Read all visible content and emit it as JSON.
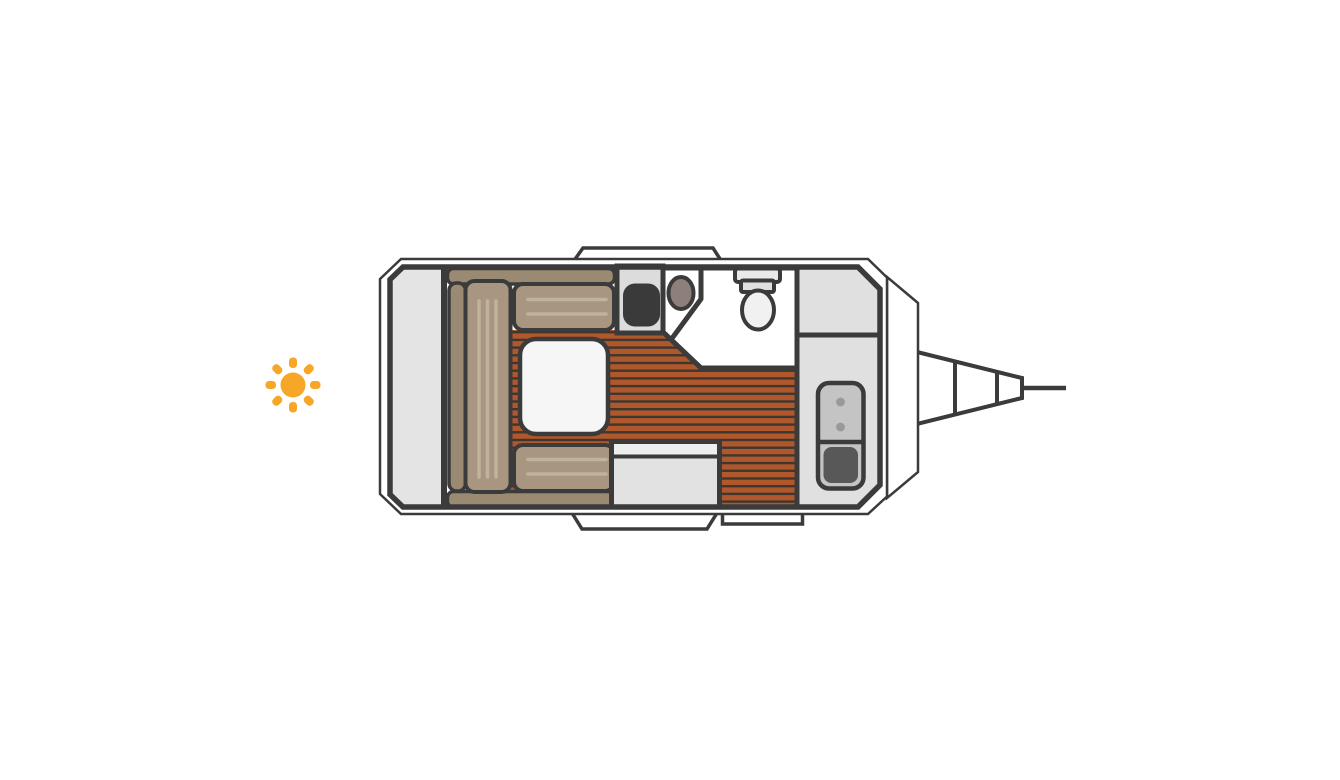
{
  "page": {
    "background": "#ffffff",
    "width": 1340,
    "height": 780
  },
  "diagram": {
    "type": "caravan-floorplan-top-view",
    "orientation": {
      "hitch_side": "right",
      "sun_marker_side": "left"
    },
    "features": [
      "sun-icon",
      "caravan-body-outline",
      "caravan-inner-wall",
      "front-nose-panel",
      "tow-hitch-drawbar",
      "hitch-coupler-line",
      "top-window-bump",
      "entry-door-bump",
      "entry-step",
      "rear-storage-platform",
      "dinette-backrest-top",
      "dinette-backrest-bottom",
      "dinette-side-bolster",
      "dinette-bed-cushion",
      "dinette-seat-top",
      "dinette-seat-bottom",
      "dinette-table",
      "wood-plank-floor",
      "kitchen-counter",
      "kitchen-sink",
      "wash-basin",
      "bathroom",
      "bathroom-partition",
      "toilet",
      "wardrobe",
      "storage-cabinet",
      "fridge-heater-unit",
      "bench-storage-box"
    ]
  },
  "colors": {
    "pageBg": "#ffffff",
    "outline": "#3b3b3b",
    "body": "#ffffff",
    "panel": "#e4e4e4",
    "cabinet": "#e0e0e0",
    "counter": "#dcdcdc",
    "bench": "#e2e2e2",
    "benchTop": "#eeeeee",
    "cushion": "#a89680",
    "cushionDark": "#998a71",
    "seam": "#c0b39b",
    "table": "#f6f6f6",
    "floor": "#b1572c",
    "floorLine": "#3e3730",
    "sink": "#3a3a3a",
    "basin": "#8d807a",
    "toilet": "#f1f1f1",
    "tank": "#e9e9e9",
    "tankLower": "#dfdfdf",
    "appliance": "#c4c4c4",
    "knob": "#999999",
    "applianceDoor": "#585858",
    "sun": "#f7a728"
  }
}
